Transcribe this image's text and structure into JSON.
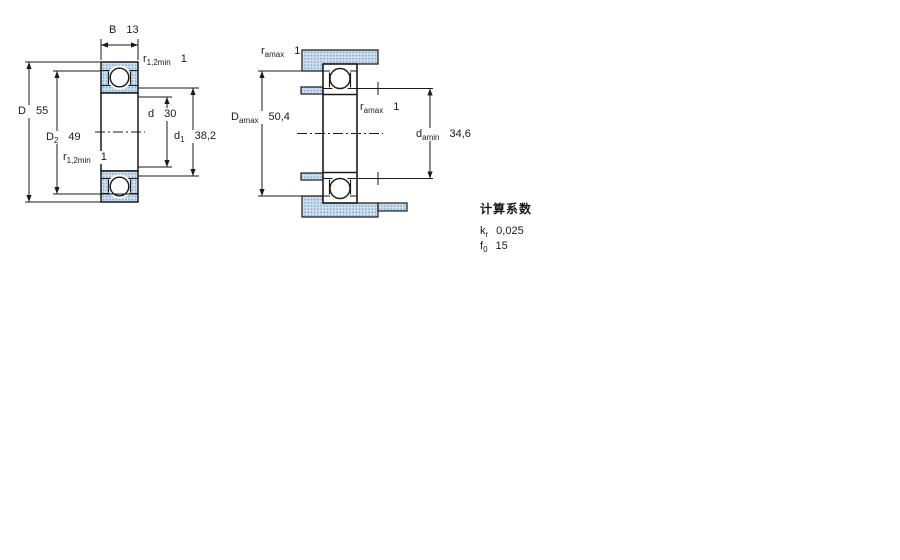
{
  "drawing_title": "deep-groove-ball-bearing-dimension-drawing",
  "dims": {
    "b": {
      "sym": "B",
      "sub": "",
      "val": "13"
    },
    "r12_top": {
      "sym": "r",
      "sub": "1,2min",
      "val": "1"
    },
    "D": {
      "sym": "D",
      "sub": "",
      "val": "55"
    },
    "D2": {
      "sym": "D",
      "sub": "2",
      "val": "49"
    },
    "r12_bottom": {
      "sym": "r",
      "sub": "1,2min",
      "val": "1"
    },
    "d": {
      "sym": "d",
      "sub": "",
      "val": "30"
    },
    "d1": {
      "sym": "d",
      "sub": "1",
      "val": "38,2"
    },
    "ramax_top": {
      "sym": "r",
      "sub": "amax",
      "val": "1"
    },
    "Damax": {
      "sym": "D",
      "sub": "amax",
      "val": "50,4"
    },
    "ramax_mid": {
      "sym": "r",
      "sub": "amax",
      "val": "1"
    },
    "damin": {
      "sym": "d",
      "sub": "amin",
      "val": "34,6"
    }
  },
  "factors": {
    "title": "计算系数",
    "kr": {
      "sym": "k",
      "sub": "r",
      "val": "0,025"
    },
    "f0": {
      "sym": "f",
      "sub": "0",
      "val": "15"
    }
  },
  "colors": {
    "line": "#1a1a1a",
    "fill_base": "#cfe0ee",
    "fill_dot": "#7fa9cf"
  }
}
